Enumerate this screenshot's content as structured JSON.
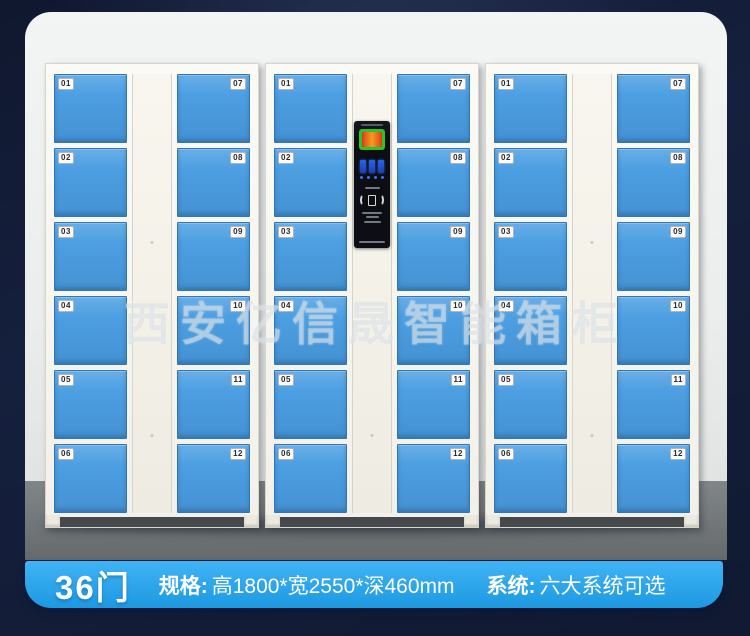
{
  "watermark": {
    "text": "西安亿信晟智能箱柜"
  },
  "banner": {
    "door_count": "36门",
    "spec_label": "规格:",
    "spec_value": "高1800*宽2550*深460mm",
    "system_label": "系统:",
    "system_value": "六大系统可选"
  },
  "colors": {
    "background_navy": "#15203e",
    "banner_blue": "#1fa6f4",
    "door_blue": "#4c9fe2",
    "cabinet_white": "#f7f5ef",
    "wall_gray": "#e9ebeb",
    "floor_gray": "#73787b",
    "panel_black": "#0c0e14",
    "screen_green": "#2fc22f",
    "keypad_blue": "#2a63e8"
  },
  "lockers": {
    "left_door_numbers": [
      "01",
      "02",
      "03",
      "04",
      "05",
      "06"
    ],
    "right_door_numbers": [
      "07",
      "08",
      "09",
      "10",
      "11",
      "12"
    ],
    "cabinets": [
      {
        "id": "cabinet-1",
        "has_panel": false
      },
      {
        "id": "cabinet-2",
        "has_panel": true
      },
      {
        "id": "cabinet-3",
        "has_panel": false
      }
    ]
  }
}
